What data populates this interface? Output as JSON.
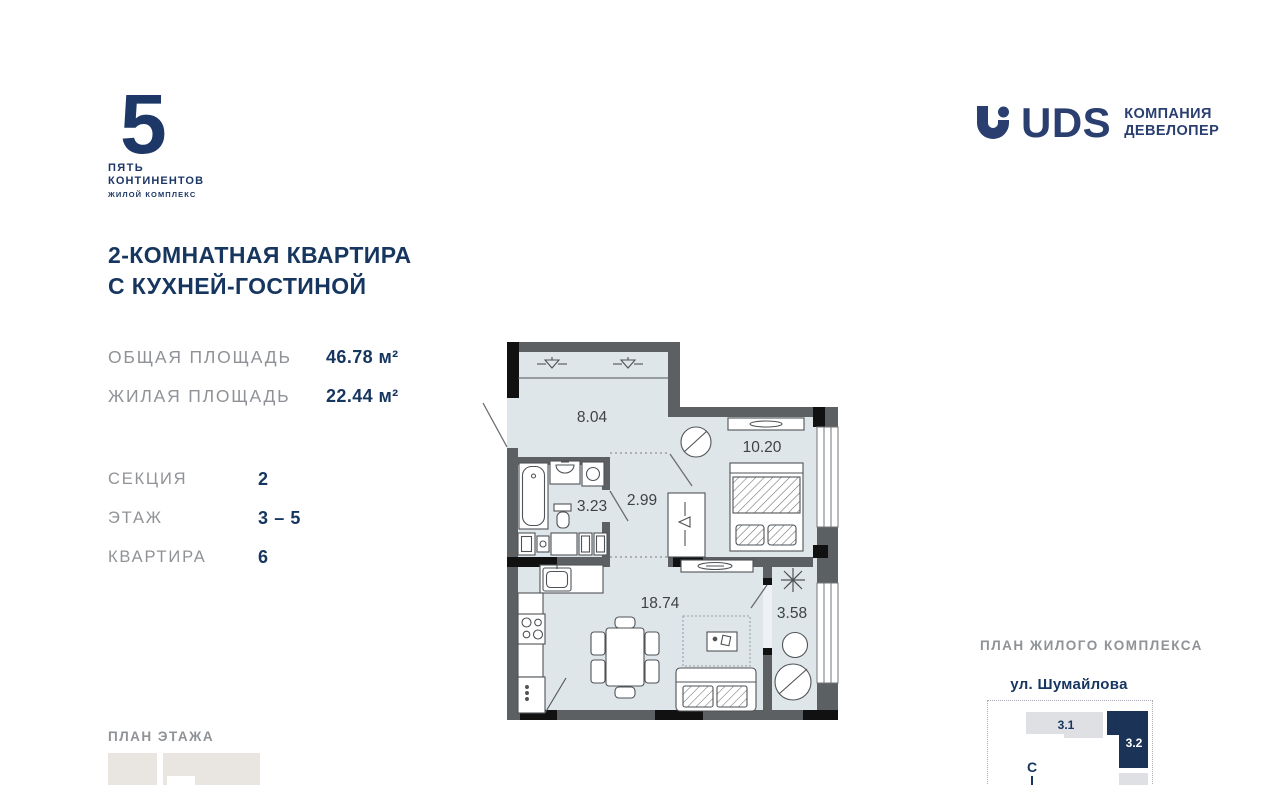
{
  "brand": {
    "number": "5",
    "line1": "ПЯТЬ",
    "line2": "КОНТИНЕНТОВ",
    "line3": "ЖИЛОЙ КОМПЛЕКС"
  },
  "developer": {
    "name": "UDS",
    "line1": "КОМПАНИЯ",
    "line2": "ДЕВЕЛОПЕР"
  },
  "header": {
    "title_line1": "2-КОМНАТНАЯ КВАРТИРА",
    "title_line2": "С КУХНЕЙ-ГОСТИНОЙ"
  },
  "stats": [
    {
      "label": "ОБЩАЯ ПЛОЩАДЬ",
      "value": "46.78 м²"
    },
    {
      "label": "ЖИЛАЯ ПЛОЩАДЬ",
      "value": "22.44 м²"
    }
  ],
  "info": [
    {
      "label": "СЕКЦИЯ",
      "value": "2"
    },
    {
      "label": "ЭТАЖ",
      "value": "3 – 5"
    },
    {
      "label": "КВАРТИРА",
      "value": "6"
    }
  ],
  "floorplan": {
    "rooms": [
      {
        "name": "hallway",
        "area": "8.04"
      },
      {
        "name": "bedroom",
        "area": "10.20"
      },
      {
        "name": "bathroom",
        "area": "3.23"
      },
      {
        "name": "corridor",
        "area": "2.99"
      },
      {
        "name": "kitchen-living-room",
        "area": "18.74"
      },
      {
        "name": "balcony",
        "area": "3.58"
      }
    ]
  },
  "sections": {
    "floor_plan_label": "ПЛАН ЭТАЖА"
  },
  "complex": {
    "label": "ПЛАН ЖИЛОГО КОМПЛЕКСА",
    "street": "ул. Шумайлова",
    "buildings": [
      {
        "id": "3.1"
      },
      {
        "id": "3.2"
      }
    ],
    "compass": "С"
  },
  "colors": {
    "accent_navy": "#1d3766",
    "text_navy": "#16355f",
    "label_gray": "#8f9296",
    "room_fill": "#dfe6ea",
    "wall_gray": "#5d6063",
    "pier_black": "#111111",
    "block_gray": "#e9e6e1",
    "highlight_navy": "#1b3357"
  }
}
